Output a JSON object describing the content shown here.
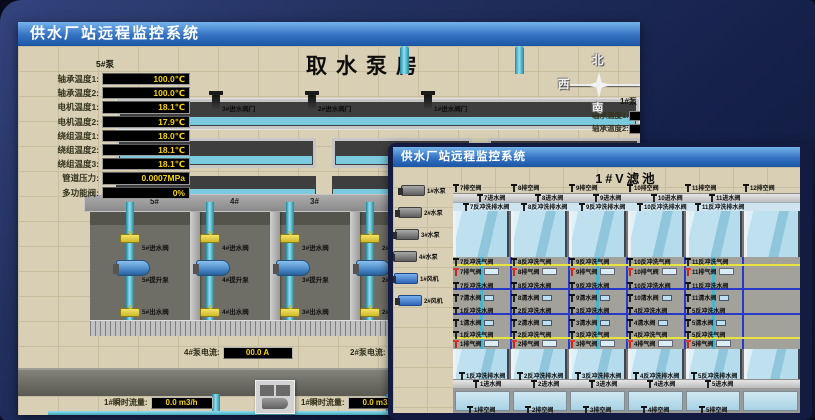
{
  "pump_house": {
    "window_title": "供水厂站远程监控系统",
    "scene_title": "取水泵房",
    "sensor_panel": {
      "header": "5#泵",
      "rows": [
        {
          "label": "轴承温度1:",
          "value": "100.0℃"
        },
        {
          "label": "轴承温度2:",
          "value": "100.0℃"
        },
        {
          "label": "电机温度1:",
          "value": "18.1℃"
        },
        {
          "label": "电机温度2:",
          "value": "17.9℃"
        },
        {
          "label": "绕组温度1:",
          "value": "18.0℃"
        },
        {
          "label": "绕组温度2:",
          "value": "18.1℃"
        },
        {
          "label": "绕组温度3:",
          "value": "18.1℃"
        },
        {
          "label": "管道压力:",
          "value": "0.0007MPa"
        },
        {
          "label": "多功能阀:",
          "value": "0%"
        }
      ]
    },
    "inlet_valve_labels": [
      "3#进水阀门",
      "2#进水阀门",
      "1#进水阀门"
    ],
    "compass": {
      "north": "北",
      "west": "西",
      "south": "南"
    },
    "partial_right_panel": {
      "pump_header": "1#泵",
      "rows": [
        "轴承温度1:",
        "轴承温度2:"
      ]
    },
    "bay_headers": [
      "5#",
      "4#",
      "3#",
      "2#"
    ],
    "pump_bays": [
      {
        "inlet": "5#进水阀",
        "pump": "5#提升泵",
        "outlet": "5#出水阀"
      },
      {
        "inlet": "4#进水阀",
        "pump": "4#提升泵",
        "outlet": "4#出水阀"
      },
      {
        "inlet": "3#进水阀",
        "pump": "3#提升泵",
        "outlet": "3#出水阀"
      },
      {
        "inlet": "2#进水阀",
        "pump": "2#提升泵",
        "outlet": "2#出水阀"
      }
    ],
    "current_readouts": [
      {
        "label": "4#泵电流:",
        "value": "00.0 A"
      },
      {
        "label": "2#泵电流:",
        "value": ""
      }
    ],
    "flow_readouts": [
      {
        "label": "1#瞬时流量:",
        "value": "0.0 m3/h"
      },
      {
        "label": "1#瞬时流量:",
        "value": "0.0 m3/h"
      }
    ]
  },
  "filter_pool": {
    "window_title": "供水厂站远程监控系统",
    "scene_title": "1#V滤池",
    "left_pumps": [
      "1#水泵",
      "2#水泵",
      "3#水泵",
      "4#水泵"
    ],
    "left_blowers": [
      "1#风机",
      "2#风机"
    ],
    "top_drain_valves": [
      "7排空阀",
      "8排空阀",
      "9排空阀",
      "10排空阀",
      "11排空阀",
      "12排空阀"
    ],
    "top_inlet_valves": [
      "7进水阀",
      "8进水阀",
      "9进水阀",
      "10进水阀",
      "11进水阀"
    ],
    "top_backwash_drain_valves": [
      "7反冲洗排水阀",
      "8反冲洗排水阀",
      "9反冲洗排水阀",
      "10反冲洗排水阀",
      "11反冲洗排水阀"
    ],
    "top_air_valves": [
      "7反冲洗气阀",
      "8反冲洗气阀",
      "9反冲洗气阀",
      "10反冲洗气阀",
      "11反冲洗气阀"
    ],
    "top_exhaust_valves": [
      "7排气阀",
      "8排气阀",
      "9排气阀",
      "10排气阀",
      "11排气阀"
    ],
    "top_water_valves": [
      "7反冲洗水阀",
      "8反冲洗水阀",
      "9反冲洗水阀",
      "10反冲洗水阀",
      "11反冲洗水阀"
    ],
    "top_clean_valves": [
      "7清水阀",
      "8清水阀",
      "9清水阀",
      "10清水阀",
      "11清水阀"
    ],
    "bottom_water_valves": [
      "1反冲洗水阀",
      "2反冲洗水阀",
      "3反冲洗水阀",
      "4反冲洗水阀",
      "5反冲洗水阀"
    ],
    "bottom_clean_valves": [
      "1清水阀",
      "2清水阀",
      "3清水阀",
      "4清水阀",
      "5清水阀"
    ],
    "bottom_air_valves": [
      "1反冲洗气阀",
      "2反冲洗气阀",
      "3反冲洗气阀",
      "4反冲洗气阀",
      "5反冲洗气阀"
    ],
    "bottom_exhaust_valves": [
      "1排气阀",
      "2排气阀",
      "3排气阀",
      "4排气阀",
      "5排气阀"
    ],
    "bottom_backwash_drain_valves": [
      "1反冲洗排水阀",
      "2反冲洗排水阀",
      "3反冲洗排水阀",
      "4反冲洗排水阀",
      "5反冲洗排水阀"
    ],
    "bottom_inlet_valves": [
      "1进水阀",
      "2进水阀",
      "3进水阀",
      "4进水阀",
      "5进水阀"
    ],
    "bottom_drain_valves": [
      "1排空阀",
      "2排空阀",
      "3排空阀",
      "4排空阀",
      "5排空阀"
    ]
  },
  "colors": {
    "titlebar_top": "#74b4ea",
    "titlebar_bottom": "#1b55a5",
    "readout_text": "#f8d400",
    "readout_bg": "#000000",
    "alarm_red": "#c3281c",
    "pipe_cyan": "#4fb9d2",
    "valve_yellow": "#e9d23e",
    "scene_beige": "#d8cfb4",
    "desktop_navy": "#1d2a58"
  }
}
